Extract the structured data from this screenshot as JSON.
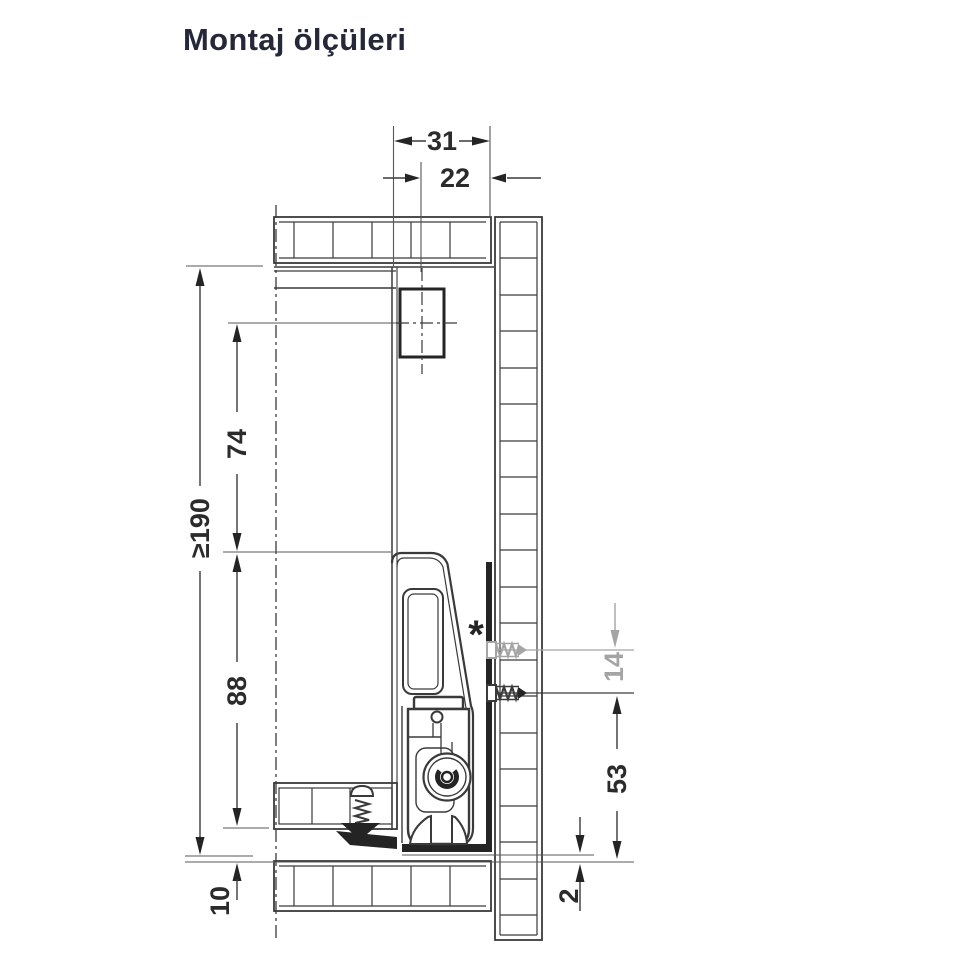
{
  "title": "Montaj ölçüleri",
  "dims": {
    "top_width": "31",
    "front_offset": "22",
    "min_height": "≥190",
    "upper_height": "74",
    "lower_height": "88",
    "bottom_offset": "10",
    "hole_gap": "14",
    "hole_height": "53",
    "clearance": "2"
  },
  "marker": "*",
  "colors": {
    "line": "#3a3a3a",
    "bold": "#242424",
    "thin": "#575757",
    "gray": "#a4a4a4",
    "text": "#2b2b2b",
    "title": "#242838"
  }
}
